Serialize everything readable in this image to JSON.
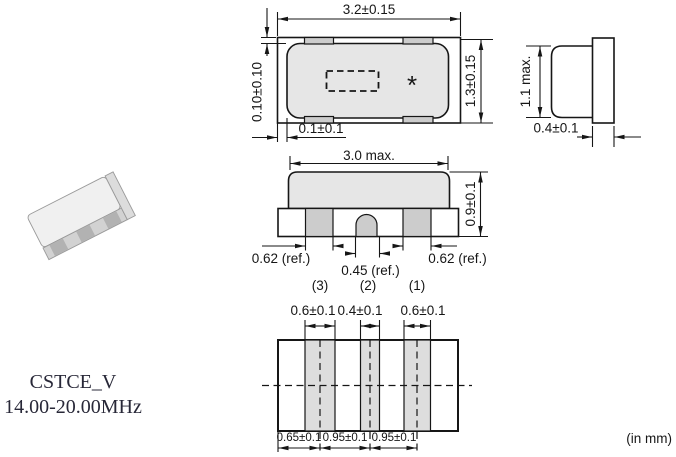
{
  "drawing": {
    "units_note": "(in mm)",
    "part_label": {
      "series": "CSTCE_V",
      "frequency_range": "14.00-20.00MHz"
    },
    "top_view": {
      "overall_width": "3.2±0.15",
      "overall_height": "1.3±0.15",
      "terminal_protrusion": "0.10±0.10",
      "terminal_inset": "0.1±0.1",
      "marking": "*"
    },
    "side_view": {
      "max_height": "1.1 max.",
      "terminal_thickness": "0.4±0.1"
    },
    "front_view": {
      "body_width": "3.0 max.",
      "body_height": "0.9±0.1",
      "left_terminal_width": "0.62 (ref.)",
      "center_terminal_width": "0.45 (ref.)",
      "right_terminal_width": "0.62 (ref.)",
      "terminal_numbers": [
        "(3)",
        "(2)",
        "(1)"
      ]
    },
    "land_pattern": {
      "pad_widths": [
        "0.6±0.1",
        "0.4±0.1",
        "0.6±0.1"
      ],
      "pad_pitches": [
        "0.65±0.1",
        "0.95±0.1",
        "0.95±0.1"
      ]
    }
  },
  "colors": {
    "line": "#161616",
    "body_fill": "#e6e6e6",
    "terminal_fill": "#cccccc",
    "land_pad_fill": "#dddddd"
  }
}
